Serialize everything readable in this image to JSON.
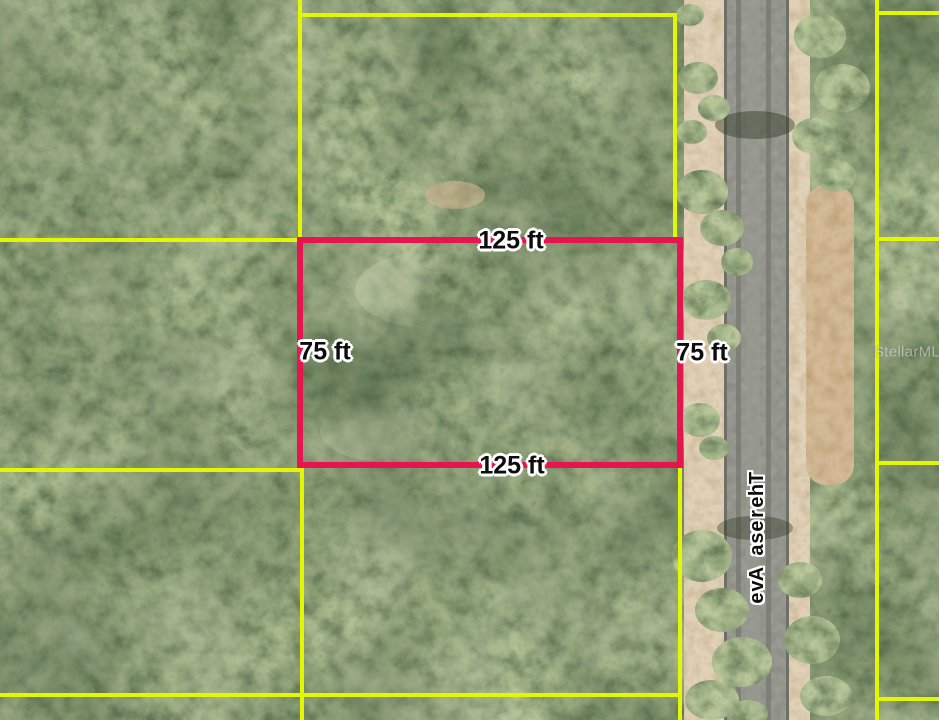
{
  "map": {
    "type": "aerial-parcel-view",
    "street": {
      "name": "Theresa Ave"
    },
    "watermark": {
      "text": "StellarMLS"
    },
    "lot": {
      "top_label": "125 ft",
      "bottom_label": "125 ft",
      "left_label": "75 ft",
      "right_label": "75 ft",
      "outline_color": "#e6154f"
    },
    "parcel_lines_color": "#e3f602",
    "label_text_color": "#0d0d0d",
    "label_outline_color": "#ffffff"
  }
}
